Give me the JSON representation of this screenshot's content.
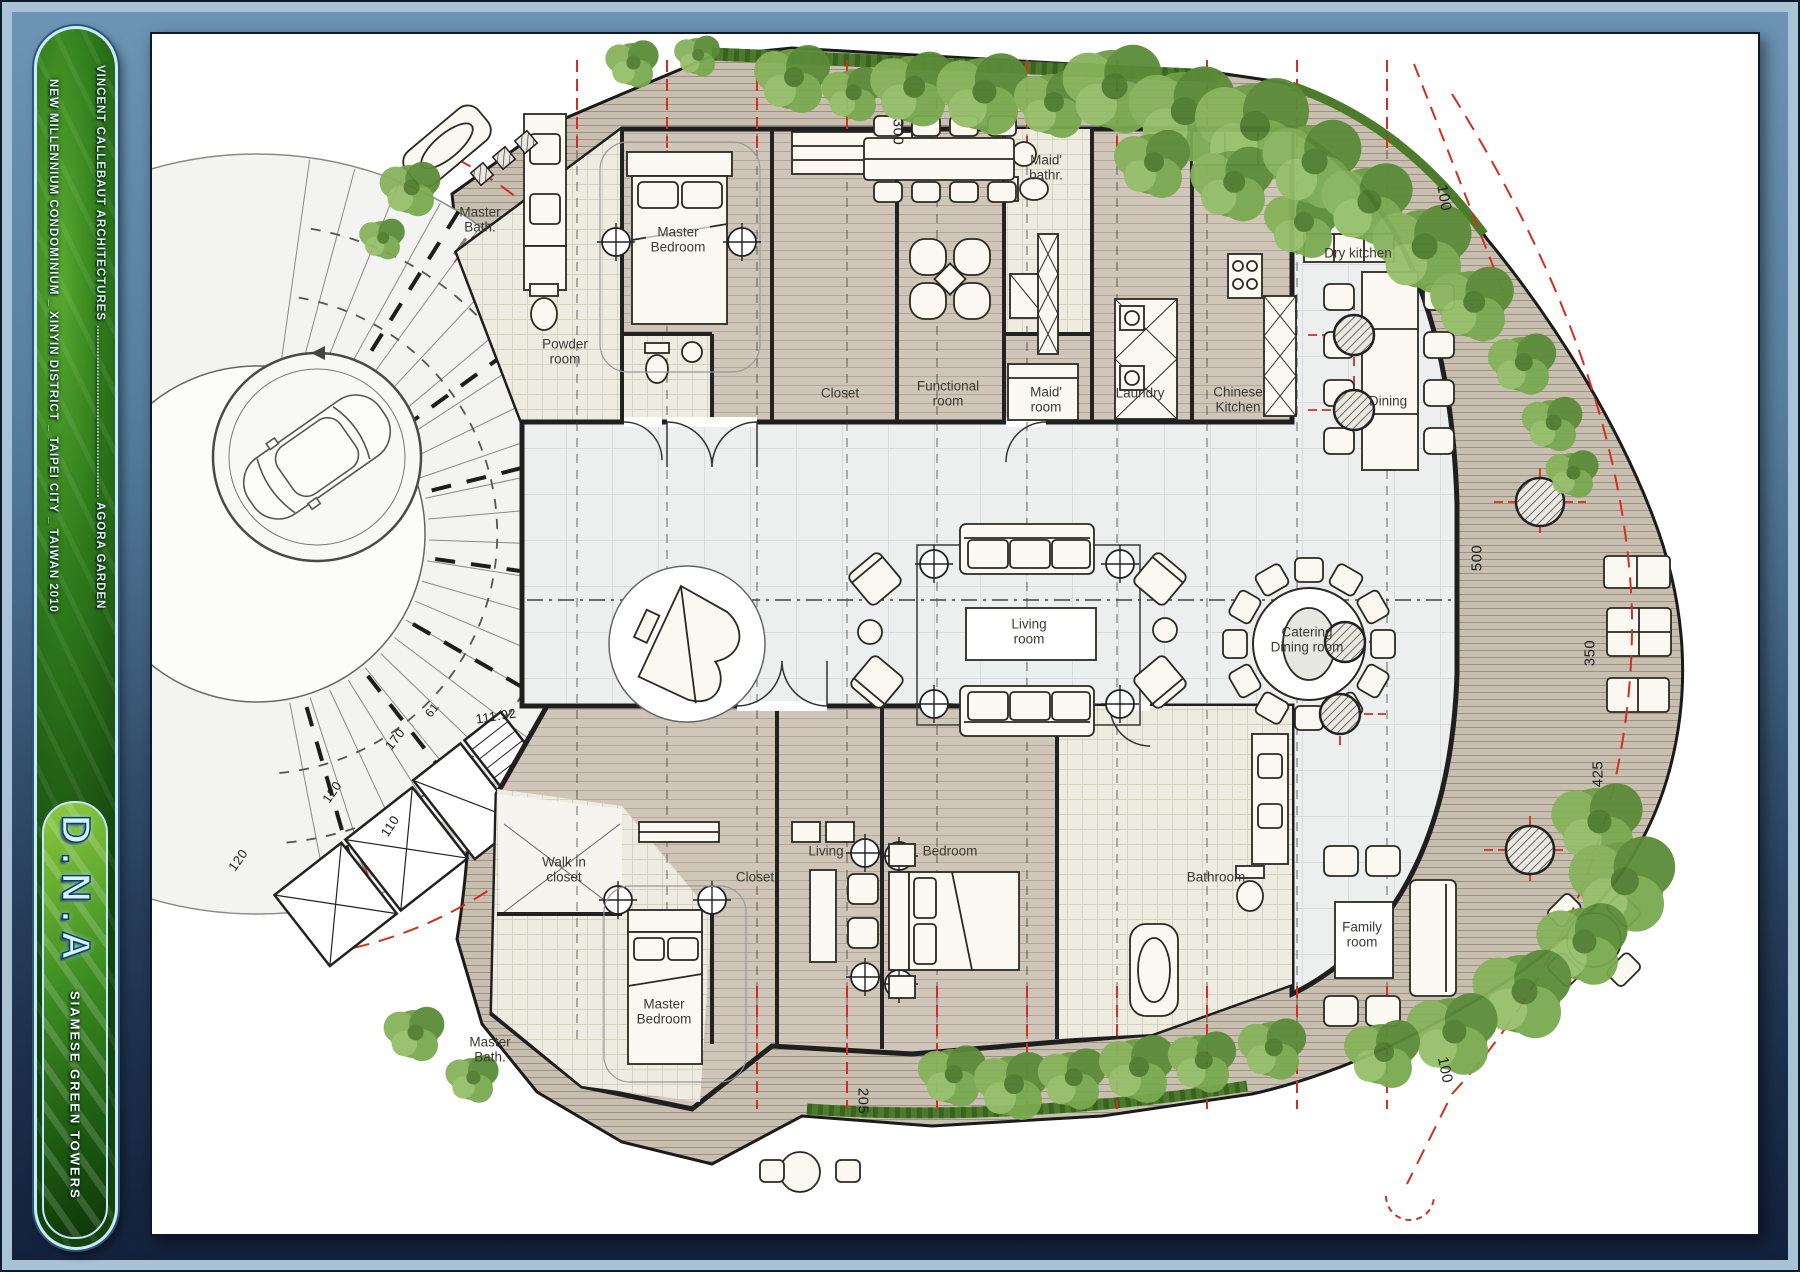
{
  "frame": {
    "sidebar": {
      "line1": "VINCENT CALLEBAUT ARCHITECTURES",
      "dots": "......................................................",
      "line1b": "AGORA GARDEN",
      "line2": "NEW MILLENNIUM CONDOMINIUM _ XINYIN DISTRICT _ TAIPEI CITY _ TAIWAN 2010",
      "logo": "D.N.A",
      "tagline": "SIAMESE GREEN TOWERS"
    }
  },
  "plan": {
    "rooms": {
      "master_bath_top": "Master Bath.",
      "master_bedroom_top": "Master Bedroom",
      "powder_room": "Powder room",
      "closet_top": "Closet",
      "functional_room": "Functional room",
      "maid_bathroom": "Maid' bathr.",
      "maid_room": "Maid' room",
      "laundry": "Laundry",
      "chinese_kitchen": "Chinese Kitchen",
      "dry_kitchen": "Dry kitchen",
      "dining": "Dining",
      "living_room": "Living room",
      "catering_dining": "Catering Dining room",
      "walk_in_closet": "Walk in closet",
      "closet_bottom": "Closet",
      "living_bottom": "Living",
      "bedroom": "Bedroom",
      "bathroom": "Bathroom",
      "family_room": "Family room",
      "master_bedroom_bottom": "Master Bedroom",
      "master_bath_bottom": "Master Bath."
    },
    "dims": {
      "d300": "300",
      "d100_top": "100",
      "d500": "500",
      "d350": "350",
      "d425": "425",
      "d205": "205",
      "d100_bottom": "100",
      "d111_92": "111.92",
      "d170": "170",
      "d61": "61",
      "d110": "110",
      "d120a": "120",
      "d120b": "120"
    }
  },
  "colors": {
    "mat_blue": "#54789f",
    "navy": "#101f38",
    "capsule_green": "#2e7a1b",
    "wing_wood": "#cfc5b8",
    "deck_wood": "#c8bfb1",
    "wall": "#1f1f1f",
    "red_grid": "#d0301f",
    "vegetation": "#6f9e45",
    "marble": "#edefef"
  }
}
